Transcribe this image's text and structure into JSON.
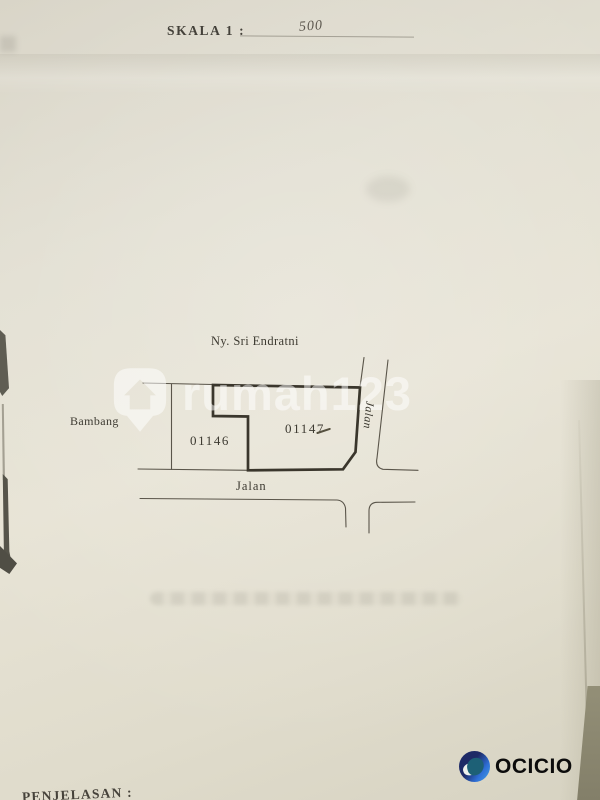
{
  "page": {
    "scale_label": "SKALA 1 :",
    "scale_value": "500"
  },
  "map": {
    "owner_label": "Ny. Sri Endratni",
    "neighbor_label": "Bambang",
    "parcel_left_number": "01146",
    "parcel_right_number": "01147",
    "road_label_horizontal": "Jalan",
    "road_label_vertical": "Jalan"
  },
  "footer": {
    "notes_heading": "PENJELASAN :"
  },
  "watermark": {
    "text": "rumah123",
    "icon": "house-pin-icon",
    "color": "#ffffff",
    "opacity": "0.5"
  },
  "brand": {
    "text": "OCICIO",
    "icon": "ocicio-circle-icon",
    "colors": {
      "navy": "#1e2a66",
      "blue": "#2e6fd6",
      "teal": "#1d6076",
      "text": "#0c0c0c"
    }
  },
  "colors": {
    "paper": "#e3dfd1",
    "line_thin": "#5a554a",
    "line_bold": "#3a362c",
    "ink": "#3d3a31"
  }
}
